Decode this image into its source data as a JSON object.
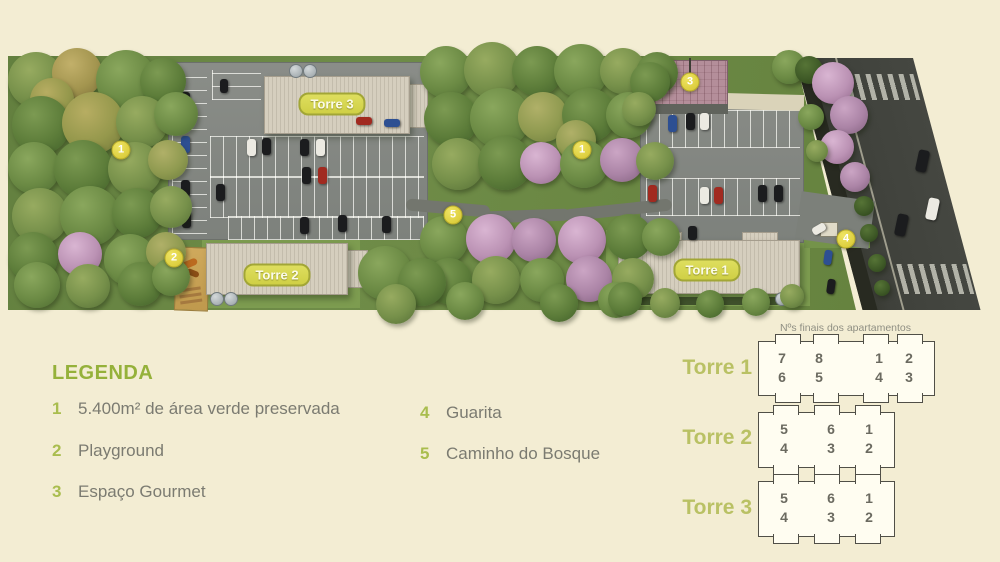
{
  "map": {
    "tower_pills": [
      "Torre 3",
      "Torre 2",
      "Torre 1"
    ],
    "markers": [
      {
        "label": "1"
      },
      {
        "label": "1"
      },
      {
        "label": "2"
      },
      {
        "label": "3"
      },
      {
        "label": "4"
      },
      {
        "label": "5"
      }
    ]
  },
  "legend": {
    "title": "LEGENDA",
    "items": [
      {
        "num": "1",
        "text": "5.400m² de área verde preservada"
      },
      {
        "num": "2",
        "text": "Playground"
      },
      {
        "num": "3",
        "text": "Espaço Gourmet"
      },
      {
        "num": "4",
        "text": "Guarita"
      },
      {
        "num": "5",
        "text": "Caminho do Bosque"
      }
    ]
  },
  "apartments": {
    "caption": "Nºs finais dos apartamentos",
    "towers": [
      {
        "label": "Torre 1",
        "top": [
          "7",
          "8",
          "1",
          "2"
        ],
        "bottom": [
          "6",
          "5",
          "4",
          "3"
        ]
      },
      {
        "label": "Torre 2",
        "top": [
          "5",
          "6",
          "1"
        ],
        "bottom": [
          "4",
          "3",
          "2"
        ]
      },
      {
        "label": "Torre 3",
        "top": [
          "5",
          "6",
          "1"
        ],
        "bottom": [
          "4",
          "3",
          "2"
        ]
      }
    ]
  },
  "colors": {
    "background": "#f3edd3",
    "accent_green": "#95b13a",
    "marker_yellow": "#ddcf3f",
    "pill_green": "#d6d64f",
    "road_gray": "#3f413b"
  }
}
